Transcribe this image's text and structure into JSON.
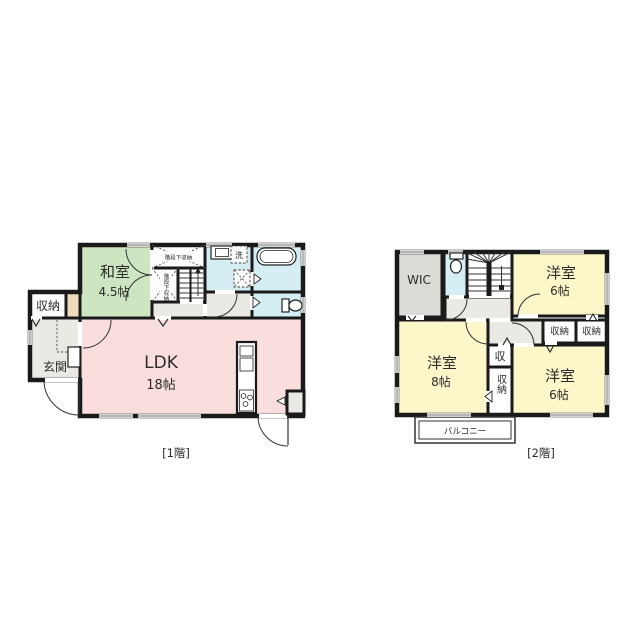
{
  "colors": {
    "tatami_green": "#cde6c1",
    "ldk_pink": "#f9dedd",
    "wet_cyan": "#d4eef4",
    "hall_gray": "#eae9e4",
    "wic_gray": "#dcdbd6",
    "bedroom_yellow": "#fbf7c9",
    "accent_beige": "#eedcb8",
    "fixture_gray": "#e9e8e4",
    "wall": "#1a1a1a"
  },
  "floor1": {
    "label": "[1階]",
    "rooms": {
      "washitsu": {
        "name": "和室",
        "size": "4.5帖"
      },
      "ldk": {
        "name": "LDK",
        "size": "18帖"
      },
      "storage": {
        "name": "収納"
      },
      "genkan": {
        "name": "玄関"
      },
      "under_stairs_top": {
        "name": "階段下収納"
      },
      "under_stairs_side": {
        "name": "階段下収納"
      },
      "laundry": {
        "name": "洗"
      }
    }
  },
  "floor2": {
    "label": "[2階]",
    "rooms": {
      "wic": {
        "name": "WIC"
      },
      "bedroom_ne": {
        "name": "洋室",
        "size": "6帖"
      },
      "bedroom_w": {
        "name": "洋室",
        "size": "8帖"
      },
      "bedroom_se": {
        "name": "洋室",
        "size": "6帖"
      },
      "closet_a": {
        "name": "収納"
      },
      "closet_b": {
        "name": "収納"
      },
      "closet_small": {
        "name": "収"
      },
      "closet_tall": {
        "name": "収納"
      },
      "balcony": {
        "name": "バルコニー"
      }
    }
  }
}
